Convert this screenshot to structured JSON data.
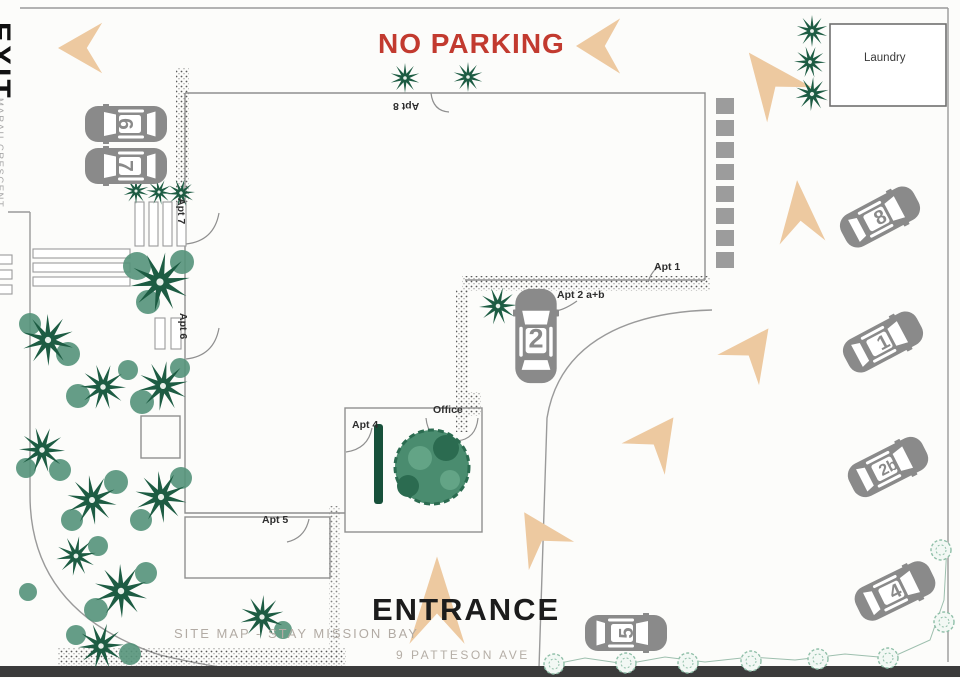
{
  "map": {
    "site_label": "SITE MAP - STAY MISSION BAY",
    "address": "9 PATTESON AVE",
    "no_parking": "NO PARKING",
    "entrance": "ENTRANCE",
    "exit": "EXIT",
    "street": "MARAU CRESCENT"
  },
  "buildings": {
    "laundry": "Laundry",
    "office": "Office"
  },
  "apartments": {
    "apt1": "Apt 1",
    "apt2ab": "Apt 2 a+b",
    "apt4": "Apt 4",
    "apt5": "Apt 5",
    "apt6": "Apt 6",
    "apt7": "Apt 7",
    "apt8": "Apt 8"
  },
  "parking": {
    "c1": "1",
    "c2": "2",
    "c2b": "2b",
    "c4": "4",
    "c5": "5",
    "c6": "6",
    "c7": "7",
    "c8": "8"
  },
  "colors": {
    "no_parking_red": "#c23a2f",
    "arrow_tan": "#edc9a0",
    "tree_dark": "#1d5c43",
    "tree_sage": "#55937a",
    "car_gray": "#8a8a8a"
  }
}
